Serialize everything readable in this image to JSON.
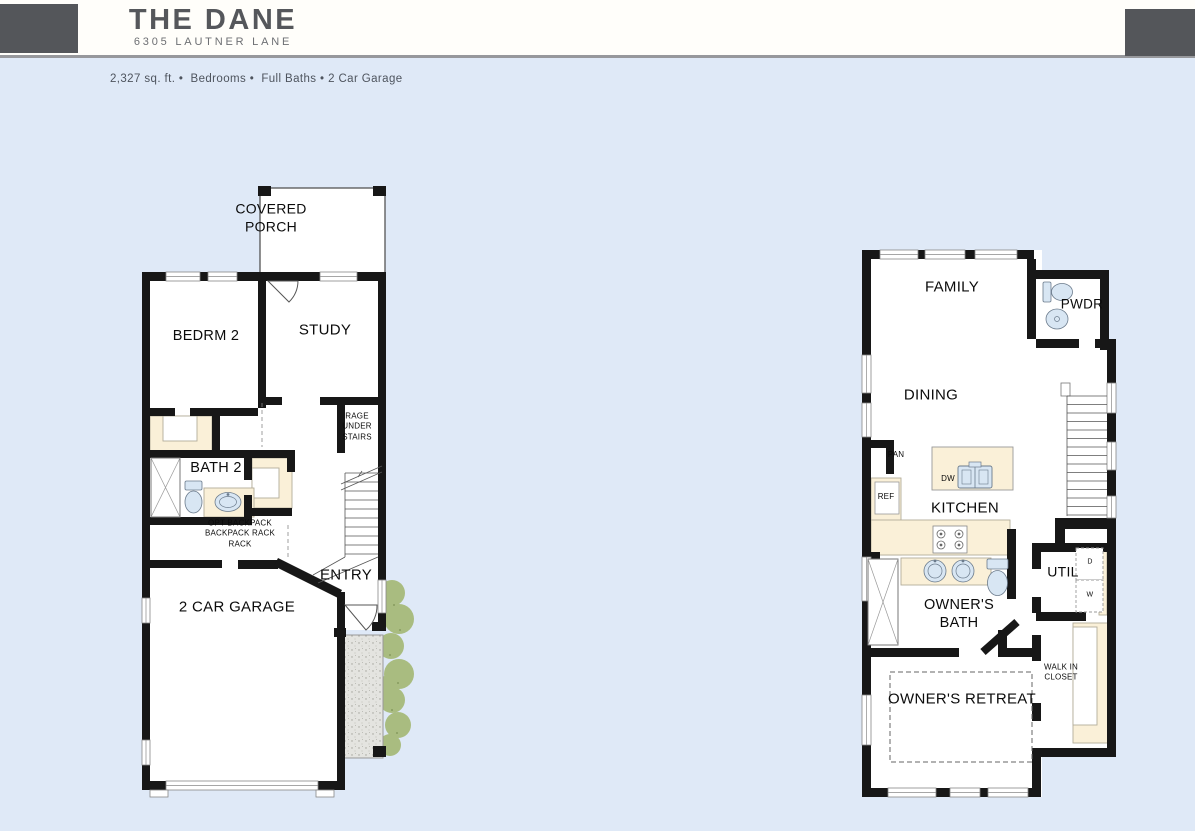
{
  "header": {
    "title": "THE DANE",
    "subtitle": "6305 LAUTNER LANE",
    "info": "2,327 sq. ft. •  Bedrooms •  Full Baths • 2 Car Garage"
  },
  "plan1": {
    "covered_porch": "COVERED\nPORCH",
    "bedrm2": "BEDRM 2",
    "study": "STUDY",
    "storage_under_stairs": "RAGE\nUNDER\nSTAIRS",
    "bath2": "BATH 2",
    "backpack_rack": "OPT BACKPACK\nBACKPACK RACK\nRACK",
    "entry": "ENTRY",
    "garage": "2 CAR GARAGE"
  },
  "plan2": {
    "family": "FAMILY",
    "pwdr": "PWDR",
    "dining": "DINING",
    "pan": "PAN",
    "ref": "REF",
    "dw": "DW",
    "kitchen": "KITCHEN",
    "owners_bath": "OWNER'S\nBATH",
    "util": "UTIL",
    "dryer": "D",
    "washer": "W",
    "walk_in_closet": "WALK IN\nCLOSET",
    "owners_retreat": "OWNER'S RETREAT"
  },
  "colors": {
    "background": "#dfe9f7",
    "header_band": "#fffefa",
    "header_block_gray": "#54565a",
    "header_border": "#97989c",
    "wall_black": "#171717",
    "cabinet_cream": "#faf0d8",
    "fixture_blue": "#d8e6f3",
    "concrete_gray": "#e4e4e0",
    "bush_green": "#a9bc80",
    "title_gray": "#55575b"
  }
}
